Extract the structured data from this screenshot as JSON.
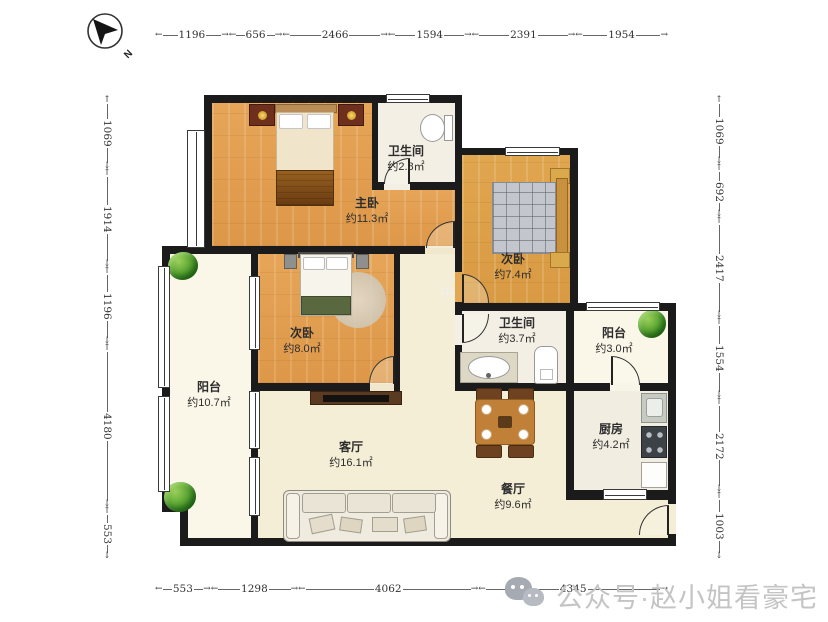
{
  "compass": {
    "label": "N"
  },
  "dimensions": {
    "top": [
      "1196",
      "656",
      "2466",
      "1594",
      "2391",
      "1954"
    ],
    "bottom": [
      "553",
      "1298",
      "4062",
      "4345"
    ],
    "left": [
      "1069",
      "1914",
      "1196",
      "4180",
      "553"
    ],
    "right": [
      "1069",
      "692",
      "2417",
      "1554",
      "2172",
      "1003"
    ]
  },
  "rooms": {
    "master": {
      "name": "主卧",
      "area": "约11.3㎡"
    },
    "bath_top": {
      "name": "卫生间",
      "area": "约2.8㎡"
    },
    "bedroom_right": {
      "name": "次卧",
      "area": "约7.4㎡"
    },
    "bath_mid": {
      "name": "卫生间",
      "area": "约3.7㎡"
    },
    "balcony_small": {
      "name": "阳台",
      "area": "约3.0㎡"
    },
    "bedroom_left": {
      "name": "次卧",
      "area": "约8.0㎡"
    },
    "balcony_large": {
      "name": "阳台",
      "area": "约10.7㎡"
    },
    "kitchen": {
      "name": "厨房",
      "area": "约4.2㎡"
    },
    "living": {
      "name": "客厅",
      "area": "约16.1㎡"
    },
    "dining": {
      "name": "餐厅",
      "area": "约9.6㎡"
    }
  },
  "watermark": {
    "text": "公众号·赵小姐看豪宅",
    "center_mark": "中"
  },
  "colors": {
    "wall": "#1b1b1b",
    "wood_floor": "#e2a152",
    "living_floor": "#f4eed6",
    "plant_green": "#57a331",
    "watermark_gray": "#c4c4c4"
  }
}
